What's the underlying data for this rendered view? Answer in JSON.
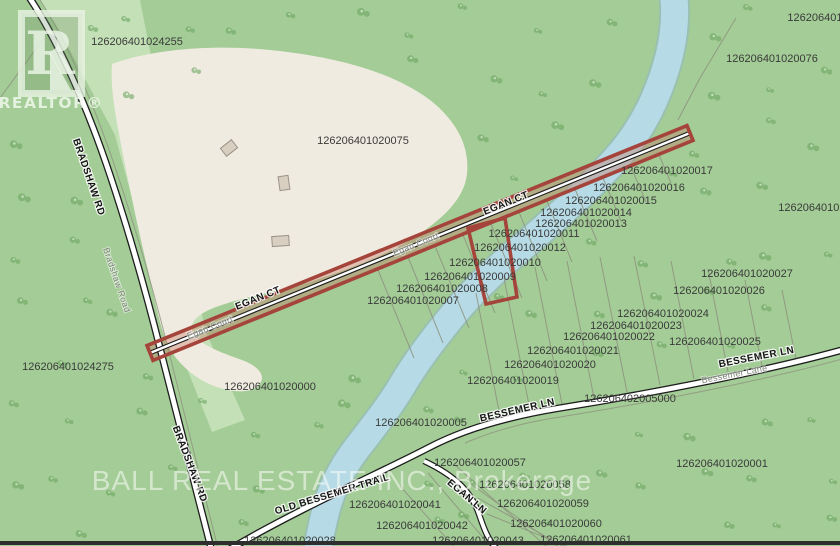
{
  "map_title": "parcel-map",
  "watermark": {
    "text": "BALL REAL ESTATE INC., Brokerage"
  },
  "logo": {
    "letter": "R",
    "label": "REALTOR®"
  },
  "colors": {
    "green_base": "#a3cc96",
    "green_light": "#c8e2ba",
    "beige": "#f0ebe0",
    "river_fill": "#b6dbe6",
    "river_edge": "#9ac0b2",
    "boundary": "#8e927f",
    "road_casing": "#1d1d1d",
    "road_fill": "#ffffff",
    "highlight_red": "#a5443b",
    "highlight_fill": "rgba(200,120,100,0.38)",
    "label_text": "#3a3a3a",
    "tree_dark": "#6fa763",
    "tree_light": "#d8ecd0",
    "building_fill": "#d9cfc0",
    "building_edge": "#9a938a",
    "border_bottom": "#2e2e2e"
  },
  "parcel_labels": [
    {
      "text": "126206401024255",
      "x": 137,
      "y": 45
    },
    {
      "text": "126206401020076",
      "x": 772,
      "y": 62
    },
    {
      "text": "1262064010",
      "x": 818,
      "y": 21
    },
    {
      "text": "126206401020075",
      "x": 363,
      "y": 144
    },
    {
      "text": "126206401020017",
      "x": 667,
      "y": 174
    },
    {
      "text": "126206401020016",
      "x": 639,
      "y": 191
    },
    {
      "text": "126206401020015",
      "x": 611,
      "y": 204
    },
    {
      "text": "126206401020014",
      "x": 586,
      "y": 216
    },
    {
      "text": "126206401020013",
      "x": 581,
      "y": 227
    },
    {
      "text": "126206401020011",
      "x": 534,
      "y": 237
    },
    {
      "text": "126206401020012",
      "x": 520,
      "y": 251
    },
    {
      "text": "126206401020010",
      "x": 495,
      "y": 266
    },
    {
      "text": "126206401020009",
      "x": 470,
      "y": 280
    },
    {
      "text": "126206401020008",
      "x": 442,
      "y": 292
    },
    {
      "text": "126206401020007",
      "x": 413,
      "y": 304
    },
    {
      "text": "126206401020000",
      "x": 270,
      "y": 390
    },
    {
      "text": "126206401024275",
      "x": 68,
      "y": 370
    },
    {
      "text": "1262064010200",
      "x": 818,
      "y": 211
    },
    {
      "text": "126206401020027",
      "x": 747,
      "y": 277
    },
    {
      "text": "126206401020026",
      "x": 719,
      "y": 294
    },
    {
      "text": "126206401020024",
      "x": 663,
      "y": 317
    },
    {
      "text": "126206401020023",
      "x": 636,
      "y": 329
    },
    {
      "text": "126206401020022",
      "x": 609,
      "y": 340
    },
    {
      "text": "126206401020025",
      "x": 715,
      "y": 345
    },
    {
      "text": "126206401020021",
      "x": 573,
      "y": 354
    },
    {
      "text": "126206401020020",
      "x": 550,
      "y": 368
    },
    {
      "text": "126206401020019",
      "x": 513,
      "y": 384
    },
    {
      "text": "126206402005000",
      "x": 630,
      "y": 402
    },
    {
      "text": "126206401020005",
      "x": 421,
      "y": 426
    },
    {
      "text": "126206401020057",
      "x": 480,
      "y": 466
    },
    {
      "text": "126206401020001",
      "x": 722,
      "y": 467
    },
    {
      "text": "126206401020058",
      "x": 525,
      "y": 488
    },
    {
      "text": "126206401020041",
      "x": 395,
      "y": 508
    },
    {
      "text": "126206401020059",
      "x": 543,
      "y": 507
    },
    {
      "text": "126206401020060",
      "x": 556,
      "y": 527
    },
    {
      "text": "126206401020042",
      "x": 422,
      "y": 529
    },
    {
      "text": "126206401020061",
      "x": 586,
      "y": 543
    },
    {
      "text": "126206401020043",
      "x": 478,
      "y": 544
    },
    {
      "text": "126206401020028",
      "x": 290,
      "y": 544
    }
  ],
  "road_labels": [
    {
      "text": "BRADSHAW RD",
      "x": 86,
      "y": 178,
      "rot": 71,
      "style": "primary"
    },
    {
      "text": "Bradshaw Road",
      "x": 114,
      "y": 281,
      "rot": 71,
      "style": "secondary"
    },
    {
      "text": "BRADSHAW RD",
      "x": 187,
      "y": 465,
      "rot": 69,
      "style": "primary"
    },
    {
      "text": "EGAN CT",
      "x": 259,
      "y": 301,
      "rot": -22,
      "style": "primary"
    },
    {
      "text": "Egan Court",
      "x": 211,
      "y": 330,
      "rot": -22,
      "style": "secondary"
    },
    {
      "text": "EGAN CT",
      "x": 507,
      "y": 206,
      "rot": -22,
      "style": "primary"
    },
    {
      "text": "Egan Court",
      "x": 417,
      "y": 247,
      "rot": -22,
      "style": "secondary"
    },
    {
      "text": "BESSEMER LN",
      "x": 518,
      "y": 413,
      "rot": -13,
      "style": "primary"
    },
    {
      "text": "BESSEMER LN",
      "x": 757,
      "y": 360,
      "rot": -11,
      "style": "primary"
    },
    {
      "text": "Bessemer Lane",
      "x": 735,
      "y": 377,
      "rot": -11,
      "style": "secondary"
    },
    {
      "text": "OLD BESSEMER TRAIL",
      "x": 333,
      "y": 497,
      "rot": -17,
      "style": "primary"
    },
    {
      "text": "EGAN LN",
      "x": 465,
      "y": 499,
      "rot": 40,
      "style": "primary"
    }
  ]
}
